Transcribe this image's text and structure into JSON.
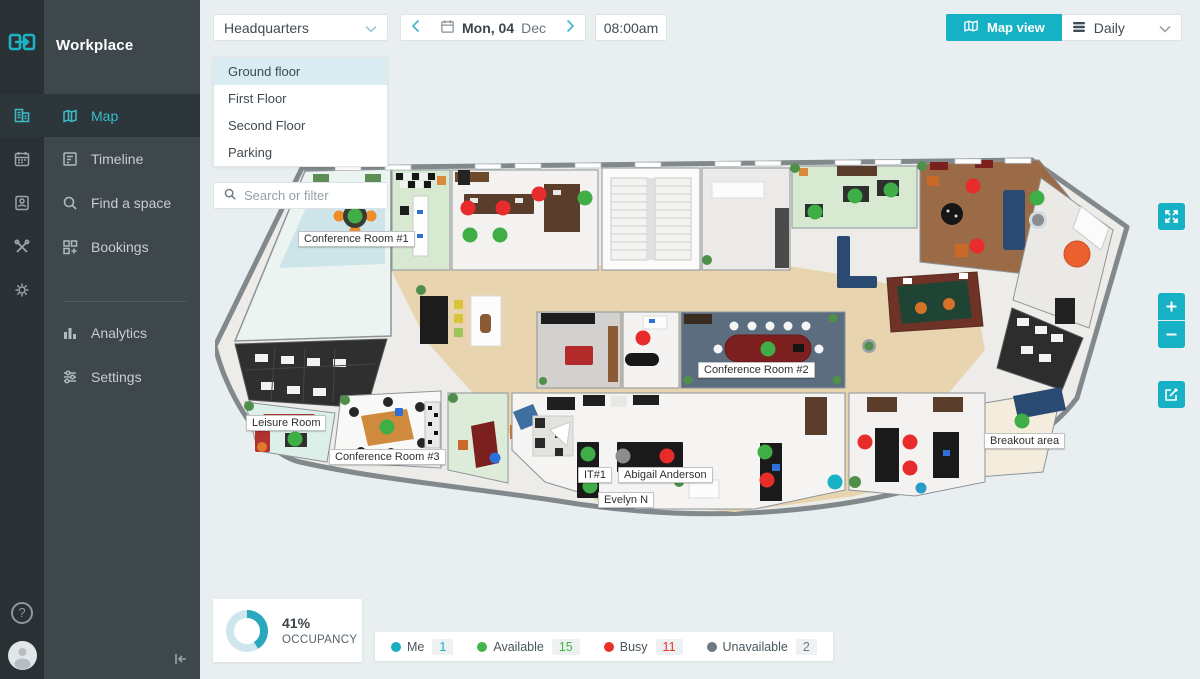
{
  "app": {
    "title": "Workplace"
  },
  "sidebar": {
    "items": [
      {
        "label": "Map",
        "active": true
      },
      {
        "label": "Timeline"
      },
      {
        "label": "Find a space"
      },
      {
        "label": "Bookings"
      },
      {
        "label": "Analytics"
      },
      {
        "label": "Settings"
      }
    ]
  },
  "topbar": {
    "location": "Headquarters",
    "date_day": "Mon, 04",
    "date_month": "Dec",
    "time": "08:00am",
    "view_toggle": "Map view",
    "frequency": "Daily"
  },
  "floors": {
    "items": [
      {
        "name": "Ground floor",
        "selected": true
      },
      {
        "name": "First Floor"
      },
      {
        "name": "Second Floor"
      },
      {
        "name": "Parking"
      }
    ]
  },
  "search": {
    "placeholder": "Search or filter"
  },
  "map": {
    "floor_name": "Ground floor",
    "labels": [
      {
        "text": "Conference Room #1"
      },
      {
        "text": "Conference Room #2"
      },
      {
        "text": "Conference Room #3"
      },
      {
        "text": "Leisure Room"
      },
      {
        "text": "Breakout area"
      },
      {
        "text": "IT#1"
      },
      {
        "text": "Abigail Anderson"
      },
      {
        "text": "Evelyn N"
      }
    ]
  },
  "occupancy": {
    "value": 41,
    "percent_label": "41%",
    "caption": "OCCUPANCY"
  },
  "legend": {
    "items": [
      {
        "label": "Me",
        "count": "1",
        "color": "#18aebf"
      },
      {
        "label": "Available",
        "count": "15",
        "color": "#43b64b"
      },
      {
        "label": "Busy",
        "count": "11",
        "color": "#e8302a"
      },
      {
        "label": "Unavailable",
        "count": "2",
        "color": "#6e797f"
      }
    ]
  }
}
